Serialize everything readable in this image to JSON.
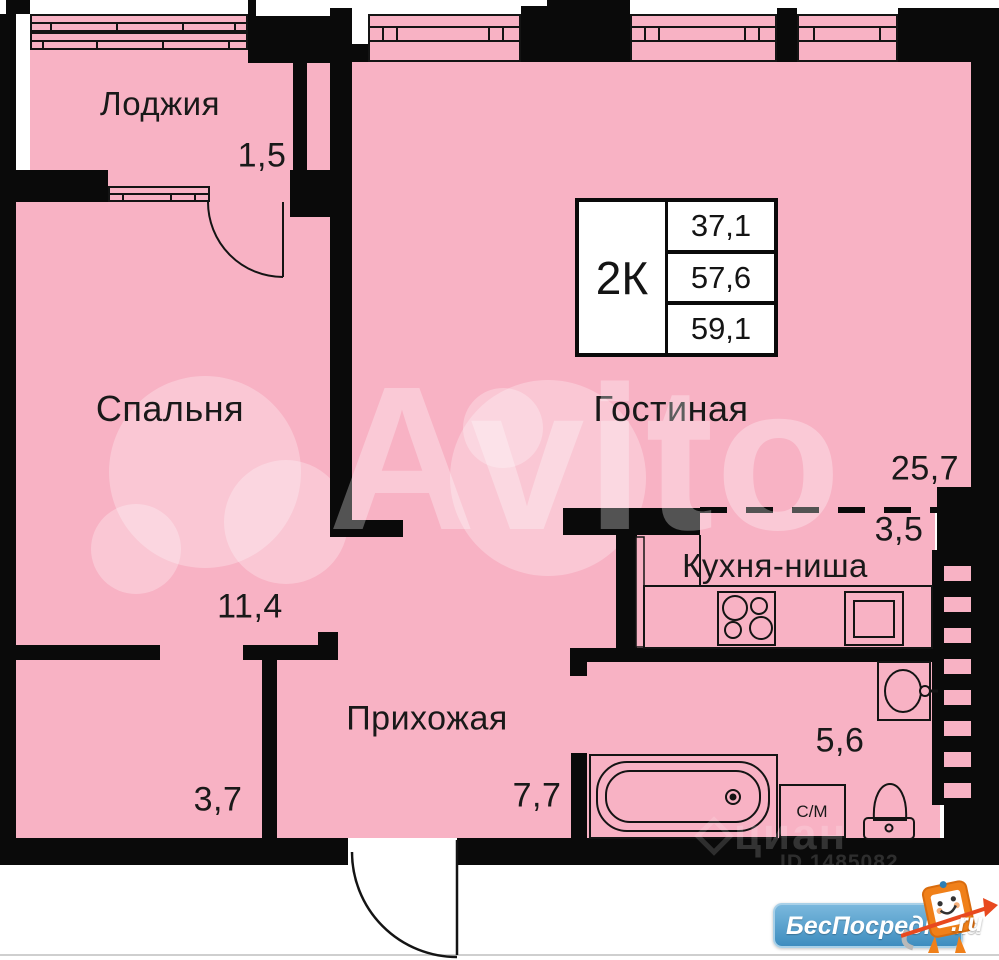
{
  "colors": {
    "room_fill": "#f8b2c4",
    "wall": "#0a0a0a",
    "logo_blue": "#4a9ac9",
    "mascot_orange": "#f08019"
  },
  "info_box": {
    "type_label": "2К",
    "area_top": "37,1",
    "area_middle": "57,6",
    "area_bottom": "59,1"
  },
  "rooms": {
    "loggia": {
      "label": "Лоджия",
      "area": "1,5"
    },
    "bedroom": {
      "label": "Спальня",
      "area": "11,4"
    },
    "living": {
      "label": "Гостиная",
      "area": "25,7"
    },
    "kitchen": {
      "label": "Кухня-ниша",
      "area": "3,5"
    },
    "hallway": {
      "label": "Прихожая",
      "area": "7,7"
    },
    "closet": {
      "area": "3,7"
    },
    "bathroom": {
      "area": "5,6",
      "washer_label": "С/М"
    }
  },
  "watermarks": {
    "avito_text": "Avito",
    "cian_text": "циан",
    "cian_id": "ID 1485082"
  },
  "branding": {
    "site_name": "БесПосредника",
    "domain_suffix": ".ru"
  }
}
